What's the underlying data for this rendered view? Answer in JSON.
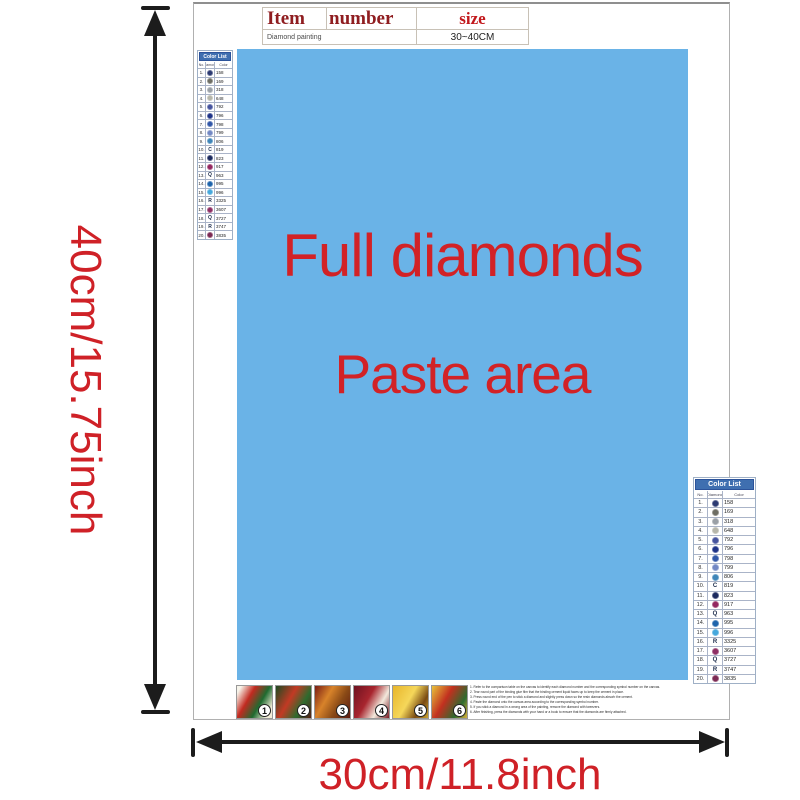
{
  "colors": {
    "accent_red": "#cf2127",
    "paste_blue": "#6ab3e7",
    "list_header_bg": "#3f6fb0",
    "table_header_red": "#8f1d20",
    "size_red": "#c2181c",
    "arrow_black": "#1c1c1c"
  },
  "dimensions": {
    "height_label": "40cm/15.75inch",
    "width_label": "30cm/11.8inch"
  },
  "item_table": {
    "headers": [
      "Item",
      "number",
      "size"
    ],
    "row": {
      "item": "Diamond painting",
      "size": "30~40CM"
    }
  },
  "paste_area": {
    "line1": "Full diamonds",
    "line2": "Paste area"
  },
  "color_list": {
    "title": "Color List",
    "columns": [
      "No.",
      "Diamond",
      "Color"
    ],
    "rows": [
      {
        "no": "1.",
        "symbol": "",
        "dot": "#2c3a72",
        "code": "158"
      },
      {
        "no": "2.",
        "symbol": "",
        "dot": "#6e6e64",
        "code": "169"
      },
      {
        "no": "3.",
        "symbol": "",
        "dot": "#9aa0a6",
        "code": "318"
      },
      {
        "no": "4.",
        "symbol": "",
        "dot": "#b6b6aa",
        "code": "648"
      },
      {
        "no": "5.",
        "symbol": "",
        "dot": "#46549e",
        "code": "792"
      },
      {
        "no": "6.",
        "symbol": "",
        "dot": "#1e3388",
        "code": "796"
      },
      {
        "no": "7.",
        "symbol": "",
        "dot": "#3157a8",
        "code": "798"
      },
      {
        "no": "8.",
        "symbol": "",
        "dot": "#7288c4",
        "code": "799"
      },
      {
        "no": "9.",
        "symbol": "",
        "dot": "#3f86b8",
        "code": "806"
      },
      {
        "no": "10.",
        "symbol": "C",
        "dot": null,
        "code": "819"
      },
      {
        "no": "11.",
        "symbol": "",
        "dot": "#1c2a5e",
        "code": "823"
      },
      {
        "no": "12.",
        "symbol": "",
        "dot": "#942760",
        "code": "917"
      },
      {
        "no": "13.",
        "symbol": "Q",
        "dot": null,
        "code": "963"
      },
      {
        "no": "14.",
        "symbol": "",
        "dot": "#1f64ab",
        "code": "995"
      },
      {
        "no": "15.",
        "symbol": "",
        "dot": "#46a8dc",
        "code": "996"
      },
      {
        "no": "16.",
        "symbol": "R",
        "dot": null,
        "code": "3325"
      },
      {
        "no": "17.",
        "symbol": "",
        "dot": "#8e2f64",
        "code": "3607"
      },
      {
        "no": "18.",
        "symbol": "Q",
        "dot": null,
        "code": "3727"
      },
      {
        "no": "19.",
        "symbol": "R",
        "dot": null,
        "code": "3747"
      },
      {
        "no": "20.",
        "symbol": "",
        "dot": "#7c2a54",
        "code": "3835"
      }
    ]
  },
  "steps": [
    {
      "num": "1",
      "bg": "linear-gradient(120deg,#f7f4ea 8%,#c22a20 35%,#1f6b30 62%,#f3ecd8 88%)"
    },
    {
      "num": "2",
      "bg": "linear-gradient(120deg,#1d4a22 0%,#c23a24 40%,#2e6b2e 70%,#571f14 100%)"
    },
    {
      "num": "3",
      "bg": "linear-gradient(120deg,#7a1d14 0%,#d8832a 35%,#8a4a16 65%,#5d1a10 100%)"
    },
    {
      "num": "4",
      "bg": "linear-gradient(120deg,#6e1220 0%,#a8252e 40%,#f2e9dc 70%,#7c1b24 100%)"
    },
    {
      "num": "5",
      "bg": "linear-gradient(120deg,#e8b52a 0%,#f5d75a 45%,#7a4a12 75%,#caa22e 100%)"
    },
    {
      "num": "6",
      "bg": "linear-gradient(120deg,#e8c23a 0%,#c2301f 40%,#2e6b2e 75%,#d8b13a 100%)"
    }
  ],
  "instructions": {
    "lines": [
      "1. Refer to the comparison table on the canvas to identify each diamond number and the corresponding symbol number on the canvas.",
      "2. Tear round part of the binding glue film that the binding cement liquid faces up to keep the cement in place.",
      "3. Press round end of the pen to stick a diamond and slightly press down so the resin diamonds absorb the cement.",
      "4. Paste the diamond onto the canvas area according to the corresponding symbol number.",
      "5. If you stick a diamond in a wrong area of the painting, remove the diamond with tweezers.",
      "6. After finishing, press the diamonds with your hand or a book to ensure that the diamonds are firmly attached."
    ]
  }
}
